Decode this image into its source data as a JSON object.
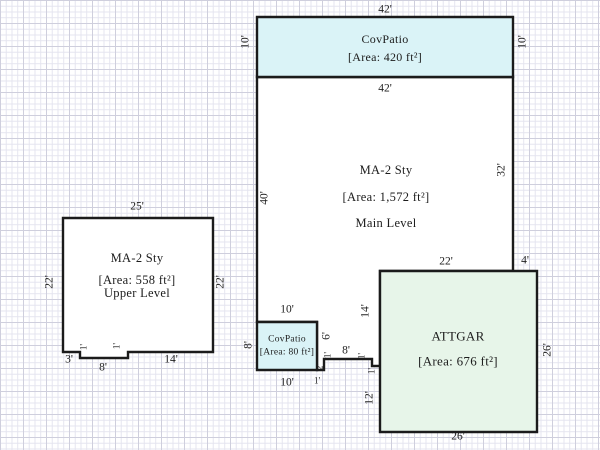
{
  "sketch": {
    "canvas": {
      "width": 600,
      "height": 450,
      "background": "#ffffff"
    },
    "grid": {
      "minor_color": "#e4e4ef",
      "major_color": "#cfcfdd",
      "minor_step": 5.75,
      "major_step": 23
    },
    "wall": {
      "color": "#1b1b1b",
      "width": 2.4
    },
    "shapes": [
      {
        "name": "main-level-outline",
        "fill": "#ffffff",
        "points": [
          [
            257,
            77
          ],
          [
            513,
            77
          ],
          [
            513,
            271
          ],
          [
            380,
            271
          ],
          [
            380,
            366
          ],
          [
            372,
            366
          ],
          [
            372,
            359
          ],
          [
            324,
            359
          ],
          [
            324,
            370
          ],
          [
            317,
            370
          ],
          [
            317,
            322
          ],
          [
            257,
            322
          ]
        ]
      },
      {
        "name": "upper-level-outline",
        "fill": "#ffffff",
        "points": [
          [
            63,
            218
          ],
          [
            213,
            218
          ],
          [
            213,
            352
          ],
          [
            128,
            352
          ],
          [
            128,
            358
          ],
          [
            80,
            358
          ],
          [
            80,
            352
          ],
          [
            63,
            352
          ]
        ]
      },
      {
        "name": "top-covpatio-outline",
        "fill": "#daf3f7",
        "points": [
          [
            257,
            17
          ],
          [
            513,
            17
          ],
          [
            513,
            77
          ],
          [
            257,
            77
          ]
        ]
      },
      {
        "name": "bottom-covpatio-outline",
        "fill": "#daf3f7",
        "points": [
          [
            257,
            322
          ],
          [
            317,
            322
          ],
          [
            317,
            370
          ],
          [
            257,
            370
          ]
        ]
      },
      {
        "name": "attached-garage-outline",
        "fill": "#e7f5e9",
        "points": [
          [
            380,
            271
          ],
          [
            537,
            271
          ],
          [
            537,
            432
          ],
          [
            380,
            432
          ]
        ]
      }
    ],
    "areas": [
      {
        "name": "top-patio",
        "font": 12,
        "lines": [
          {
            "text": "CovPatio",
            "x": 385,
            "y": 39
          },
          {
            "text": "[Area: 420 ft²]",
            "x": 385,
            "y": 57
          }
        ]
      },
      {
        "name": "main-level",
        "font": 12.5,
        "lines": [
          {
            "text": "MA-2 Sty",
            "x": 386,
            "y": 170
          },
          {
            "text": "[Area: 1,572 ft²]",
            "x": 386,
            "y": 197
          },
          {
            "text": "Main Level",
            "x": 386,
            "y": 223
          }
        ]
      },
      {
        "name": "upper-level",
        "font": 12.5,
        "lines": [
          {
            "text": "MA-2 Sty",
            "x": 137,
            "y": 258
          },
          {
            "text": "[Area: 558 ft²]",
            "x": 137,
            "y": 280
          },
          {
            "text": "Upper Level",
            "x": 137,
            "y": 293
          }
        ]
      },
      {
        "name": "bottom-patio",
        "font": 9.5,
        "lines": [
          {
            "text": "CovPatio",
            "x": 287,
            "y": 340
          },
          {
            "text": "[Area: 80 ft²]",
            "x": 287,
            "y": 353
          }
        ]
      },
      {
        "name": "attached-garage",
        "font": 13,
        "lines": [
          {
            "text": "ATTGAR",
            "x": 458,
            "y": 336
          },
          {
            "text": "[Area: 676 ft²]",
            "x": 458,
            "y": 361
          }
        ]
      }
    ],
    "dimension_labels": [
      {
        "text": "42'",
        "x": 385,
        "y": 10,
        "rot": 0
      },
      {
        "text": "10'",
        "x": 246,
        "y": 42,
        "rot": -90
      },
      {
        "text": "10'",
        "x": 523,
        "y": 42,
        "rot": -90
      },
      {
        "text": "42'",
        "x": 385,
        "y": 89,
        "rot": 0
      },
      {
        "text": "40'",
        "x": 265,
        "y": 198,
        "rot": -90
      },
      {
        "text": "32'",
        "x": 502,
        "y": 170,
        "rot": -90
      },
      {
        "text": "25'",
        "x": 137,
        "y": 207,
        "rot": 0
      },
      {
        "text": "22'",
        "x": 50,
        "y": 282,
        "rot": -90
      },
      {
        "text": "22'",
        "x": 221,
        "y": 282,
        "rot": -90
      },
      {
        "text": "3'",
        "x": 69,
        "y": 360,
        "rot": 0
      },
      {
        "text": "1'",
        "x": 84,
        "y": 347,
        "rot": -90,
        "small": true
      },
      {
        "text": "1'",
        "x": 117,
        "y": 346,
        "rot": -90,
        "small": true
      },
      {
        "text": "8'",
        "x": 103,
        "y": 368,
        "rot": 0
      },
      {
        "text": "14'",
        "x": 171,
        "y": 360,
        "rot": 0
      },
      {
        "text": "10'",
        "x": 287,
        "y": 310,
        "rot": 0
      },
      {
        "text": "8'",
        "x": 249,
        "y": 345,
        "rot": -90
      },
      {
        "text": "10'",
        "x": 287,
        "y": 383,
        "rot": 0
      },
      {
        "text": "6'",
        "x": 327,
        "y": 336,
        "rot": -90
      },
      {
        "text": "8'",
        "x": 346,
        "y": 351,
        "rot": 0
      },
      {
        "text": "1'",
        "x": 328,
        "y": 355,
        "rot": -90,
        "small": true
      },
      {
        "text": "2'",
        "x": 320,
        "y": 367,
        "rot": -90,
        "small": true
      },
      {
        "text": "1'",
        "x": 317,
        "y": 381,
        "rot": 0,
        "small": true
      },
      {
        "text": "1'",
        "x": 362,
        "y": 356,
        "rot": -90,
        "small": true
      },
      {
        "text": "1'",
        "x": 372,
        "y": 371,
        "rot": -90,
        "small": true
      },
      {
        "text": "14'",
        "x": 366,
        "y": 311,
        "rot": -90
      },
      {
        "text": "12'",
        "x": 370,
        "y": 398,
        "rot": -90
      },
      {
        "text": "22'",
        "x": 446,
        "y": 262,
        "rot": 0
      },
      {
        "text": "4'",
        "x": 525,
        "y": 261,
        "rot": 0
      },
      {
        "text": "26'",
        "x": 548,
        "y": 350,
        "rot": -90
      },
      {
        "text": "26'",
        "x": 458,
        "y": 437,
        "rot": 0
      }
    ]
  }
}
